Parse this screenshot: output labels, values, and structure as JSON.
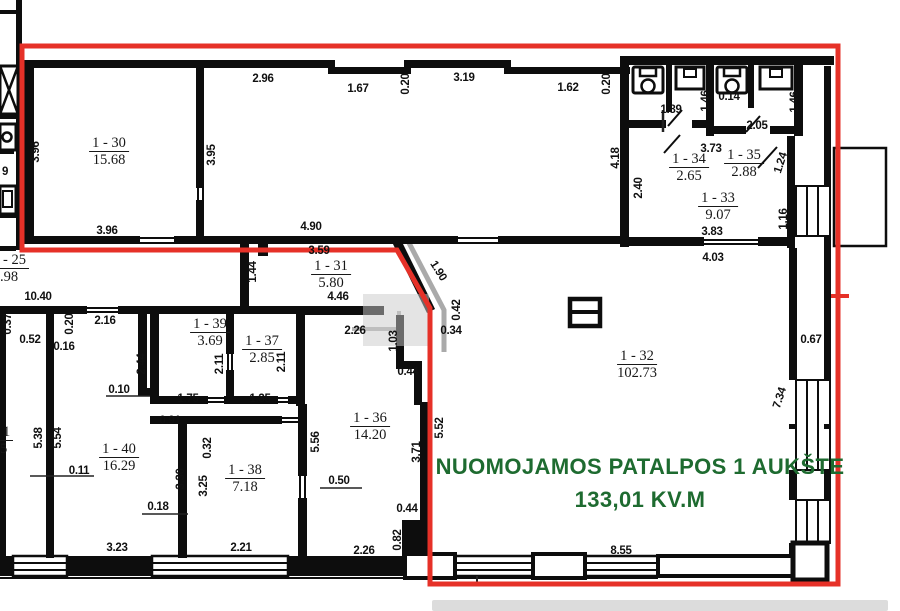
{
  "plan_title": "Floor plan - 1st floor rental premises",
  "overlay": {
    "line1": "NUOMOJAMOS PATALPOS 1 AUKŠTE",
    "line2": "133,01 KV.M",
    "color": "#1e6b30"
  },
  "colors": {
    "outline": "#e63128",
    "wall": "#0d0d0d",
    "gray": "#aaaaaa"
  },
  "rooms": [
    {
      "id": "1 - 30",
      "area": "15.68",
      "cx": 109,
      "cy": 135
    },
    {
      "id": "1 - 31",
      "area": "5.80",
      "cx": 331,
      "cy": 258
    },
    {
      "id": "1 - 32",
      "area": "102.73",
      "cx": 637,
      "cy": 348
    },
    {
      "id": "1 - 33",
      "area": "9.07",
      "cx": 718,
      "cy": 190
    },
    {
      "id": "1 - 34",
      "area": "2.65",
      "cx": 689,
      "cy": 151
    },
    {
      "id": "1 - 35",
      "area": "2.88",
      "cx": 744,
      "cy": 147
    },
    {
      "id": "1 - 36",
      "area": "14.20",
      "cx": 370,
      "cy": 410
    },
    {
      "id": "1 - 37",
      "area": "2.85",
      "cx": 262,
      "cy": 333
    },
    {
      "id": "1 - 38",
      "area": "7.18",
      "cx": 245,
      "cy": 462
    },
    {
      "id": "1 - 39",
      "area": "3.69",
      "cx": 210,
      "cy": 316
    },
    {
      "id": "1 - 40",
      "area": "16.29",
      "cx": 119,
      "cy": 441
    }
  ],
  "partial_labels": [
    {
      "id": "- 25",
      "area": ".98",
      "x": 0,
      "y": 252
    },
    {
      "id": "1",
      "area": "5",
      "x": 0,
      "y": 424
    }
  ],
  "dimensions": [
    {
      "t": "2.96",
      "x": 263,
      "y": 79,
      "r": 0
    },
    {
      "t": "1.67",
      "x": 358,
      "y": 89,
      "r": 0
    },
    {
      "t": "0.20",
      "x": 406,
      "y": 84,
      "r": -90
    },
    {
      "t": "3.19",
      "x": 464,
      "y": 78,
      "r": 0
    },
    {
      "t": "1.62",
      "x": 568,
      "y": 88,
      "r": 0
    },
    {
      "t": "0.20",
      "x": 607,
      "y": 84,
      "r": -90
    },
    {
      "t": "4.18",
      "x": 616,
      "y": 158,
      "r": -90
    },
    {
      "t": "1.89",
      "x": 671,
      "y": 110,
      "r": 0
    },
    {
      "t": "1.46",
      "x": 706,
      "y": 101,
      "r": -90
    },
    {
      "t": "0.14",
      "x": 729,
      "y": 97,
      "r": 0
    },
    {
      "t": "2.05",
      "x": 757,
      "y": 126,
      "r": 0
    },
    {
      "t": "1.46",
      "x": 795,
      "y": 102,
      "r": -90
    },
    {
      "t": "3.73",
      "x": 711,
      "y": 149,
      "r": 0
    },
    {
      "t": "1.24",
      "x": 781,
      "y": 163,
      "r": -72
    },
    {
      "t": "2.40",
      "x": 639,
      "y": 188,
      "r": -90
    },
    {
      "t": "3.83",
      "x": 712,
      "y": 232,
      "r": 0
    },
    {
      "t": "4.03",
      "x": 713,
      "y": 258,
      "r": 0
    },
    {
      "t": "1.16",
      "x": 784,
      "y": 219,
      "r": -90
    },
    {
      "t": "3.96",
      "x": 36,
      "y": 152,
      "r": -90
    },
    {
      "t": "3.95",
      "x": 212,
      "y": 155,
      "r": -90
    },
    {
      "t": "3.96",
      "x": 107,
      "y": 231,
      "r": 0
    },
    {
      "t": "4.90",
      "x": 311,
      "y": 227,
      "r": 0
    },
    {
      "t": "3.59",
      "x": 319,
      "y": 251,
      "r": 0
    },
    {
      "t": "1.44",
      "x": 253,
      "y": 272,
      "r": -90
    },
    {
      "t": "4.46",
      "x": 338,
      "y": 297,
      "r": 0
    },
    {
      "t": "2.26",
      "x": 355,
      "y": 331,
      "r": 0
    },
    {
      "t": "1.90",
      "x": 438,
      "y": 271,
      "r": 58
    },
    {
      "t": "0.42",
      "x": 457,
      "y": 310,
      "r": -90
    },
    {
      "t": "0.34",
      "x": 451,
      "y": 331,
      "r": 0
    },
    {
      "t": "1.03",
      "x": 394,
      "y": 341,
      "r": -90
    },
    {
      "t": "0.44",
      "x": 408,
      "y": 372,
      "r": 0
    },
    {
      "t": "10.40",
      "x": 38,
      "y": 297,
      "r": 0
    },
    {
      "t": "0.37",
      "x": 8,
      "y": 324,
      "r": -90
    },
    {
      "t": "0.52",
      "x": 30,
      "y": 340,
      "r": 0
    },
    {
      "t": "0.20",
      "x": 70,
      "y": 324,
      "r": -90
    },
    {
      "t": "0.16",
      "x": 64,
      "y": 347,
      "r": 0
    },
    {
      "t": "2.16",
      "x": 105,
      "y": 321,
      "r": 0
    },
    {
      "t": "2.44",
      "x": 142,
      "y": 364,
      "r": -90
    },
    {
      "t": "0.10",
      "x": 119,
      "y": 390,
      "r": 0
    },
    {
      "t": "5.38",
      "x": 39,
      "y": 438,
      "r": -90
    },
    {
      "t": "5.54",
      "x": 58,
      "y": 438,
      "r": -90
    },
    {
      "t": "0.11",
      "x": 79,
      "y": 471,
      "r": 0
    },
    {
      "t": "0.91",
      "x": 170,
      "y": 421,
      "r": 0
    },
    {
      "t": "2.11",
      "x": 220,
      "y": 364,
      "r": -90
    },
    {
      "t": "2.11",
      "x": 282,
      "y": 362,
      "r": -90
    },
    {
      "t": "1.75",
      "x": 188,
      "y": 399,
      "r": 0
    },
    {
      "t": "1.35",
      "x": 260,
      "y": 399,
      "r": 0
    },
    {
      "t": "0.32",
      "x": 208,
      "y": 448,
      "r": -90
    },
    {
      "t": "3.25",
      "x": 204,
      "y": 486,
      "r": -90
    },
    {
      "t": "3.30",
      "x": 181,
      "y": 479,
      "r": -90
    },
    {
      "t": "0.18",
      "x": 158,
      "y": 507,
      "r": 0
    },
    {
      "t": "3.23",
      "x": 117,
      "y": 548,
      "r": 0
    },
    {
      "t": "2.21",
      "x": 241,
      "y": 548,
      "r": 0
    },
    {
      "t": "5.56",
      "x": 316,
      "y": 442,
      "r": -90
    },
    {
      "t": "0.50",
      "x": 339,
      "y": 481,
      "r": 0
    },
    {
      "t": "3.71",
      "x": 417,
      "y": 452,
      "r": -90
    },
    {
      "t": "5.52",
      "x": 440,
      "y": 428,
      "r": -90
    },
    {
      "t": "0.44",
      "x": 407,
      "y": 509,
      "r": 0
    },
    {
      "t": "0.82",
      "x": 398,
      "y": 540,
      "r": -90
    },
    {
      "t": "2.26",
      "x": 364,
      "y": 551,
      "r": 0
    },
    {
      "t": "8.55",
      "x": 621,
      "y": 551,
      "r": 0
    },
    {
      "t": "7.34",
      "x": 780,
      "y": 398,
      "r": -72
    },
    {
      "t": "0.67",
      "x": 811,
      "y": 340,
      "r": 0
    },
    {
      "t": "9",
      "x": 5,
      "y": 172,
      "r": 0
    }
  ]
}
